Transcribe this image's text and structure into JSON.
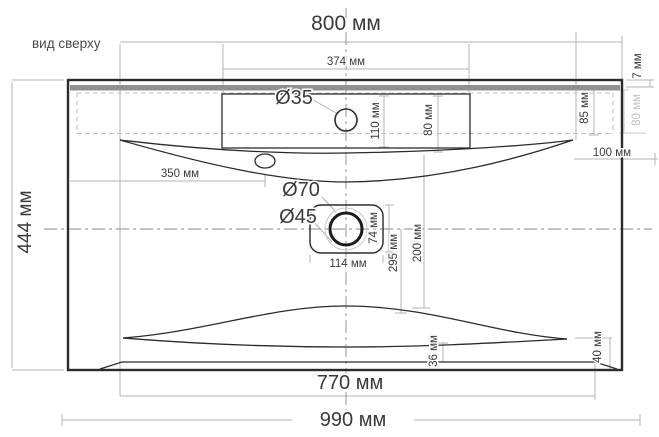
{
  "drawing": {
    "title": "вид сверху",
    "labels": {
      "width_overall": "800 мм",
      "width_shelf": "374 мм",
      "faucet_hole": "Ø35",
      "shelf_depth_110": "110 мм",
      "shelf_depth_80": "80 мм",
      "rim_7": "7 мм",
      "back_85": "85 мм",
      "back_80_gray": "80 мм",
      "corner_100": "100 мм",
      "overflow_350": "350 мм",
      "drain_recess": "Ø70",
      "drain_hole": "Ø45",
      "drain_74": "74 мм",
      "drain_114": "114 мм",
      "depth_295": "295 мм",
      "depth_200": "200 мм",
      "depth_overall": "444 мм",
      "front_36": "36 мм",
      "front_40": "40 мм",
      "base_width": "770 мм",
      "total_width": "990 мм"
    },
    "colors": {
      "outline": "#2b2b2b",
      "dimension_line": "#b3b3b3",
      "hidden_edge": "#c0c0c0",
      "gray_bar": "#909090",
      "muted_label": "#c0c0c0",
      "text": "#3a3a3a"
    }
  }
}
